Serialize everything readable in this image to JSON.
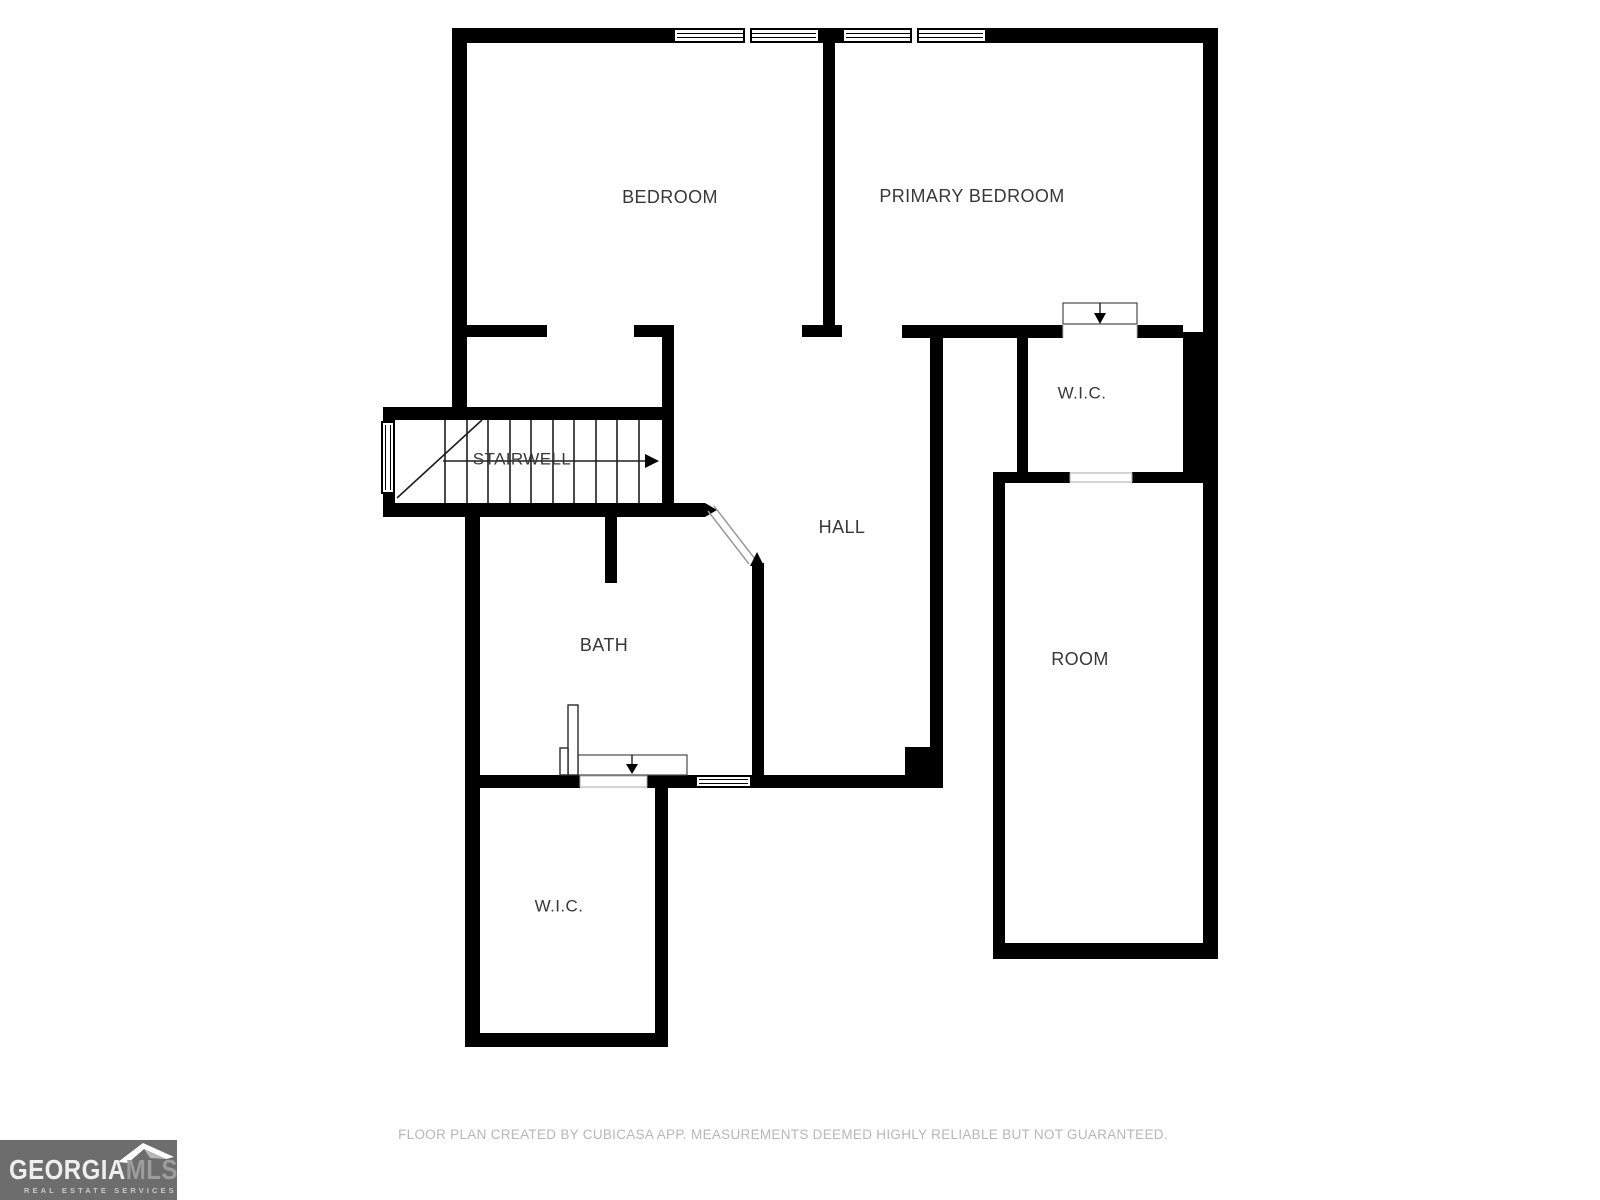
{
  "rooms": {
    "bedroom": {
      "label": "BEDROOM"
    },
    "primary_bedroom": {
      "label": "PRIMARY BEDROOM"
    },
    "wic_upper": {
      "label": "W.I.C."
    },
    "stairwell": {
      "label": "STAIRWELL"
    },
    "hall": {
      "label": "HALL"
    },
    "bath": {
      "label": "BATH"
    },
    "room": {
      "label": "ROOM"
    },
    "wic_lower": {
      "label": "W.I.C."
    }
  },
  "footer": {
    "disclaimer": "FLOOR PLAN CREATED BY CUBICASA APP. MEASUREMENTS DEEMED HIGHLY RELIABLE BUT NOT GUARANTEED."
  },
  "logo": {
    "georgia": "GEORGIA",
    "mls": "MLS",
    "tagline": "REAL ESTATE SERVICES"
  },
  "icons": {
    "stairs_direction": "right-arrow",
    "door_entry_upper_wic": "down-arrow",
    "door_entry_lower_wic": "down-arrow"
  },
  "colors": {
    "wall": "#000000",
    "label_text": "#383838",
    "disclaimer_text": "#b7b7b7",
    "logo_background": "#6d6d6d"
  }
}
